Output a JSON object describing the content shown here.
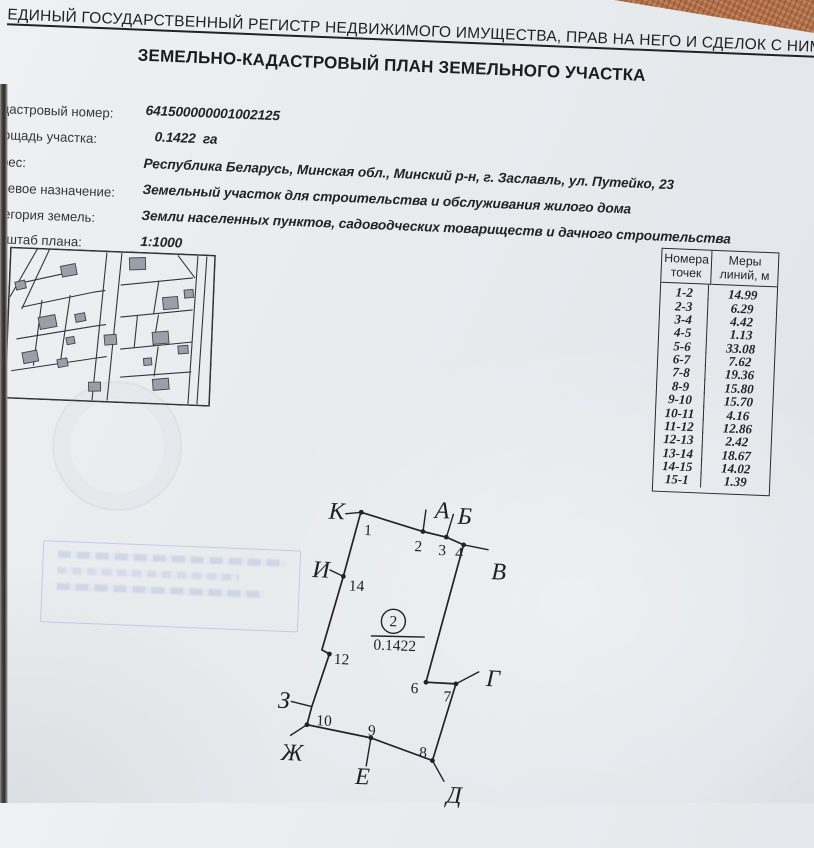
{
  "header": {
    "registry_line": "ЕДИНЫЙ ГОСУДАРСТВЕННЫЙ РЕГИСТР НЕДВИЖИМОГО ИМУЩЕСТВА, ПРАВ НА НЕГО И СДЕЛОК С НИМ",
    "title": "ЗЕМЕЛЬНО-КАДАСТРОВЫЙ ПЛАН ЗЕМЕЛЬНОГО УЧАСТКА"
  },
  "fields": [
    {
      "label": "Кадастровый номер:",
      "value": "641500000001002125"
    },
    {
      "label": "Площадь участка:",
      "value": "0.1422  га"
    },
    {
      "label": "Адрес:",
      "value": "Республика Беларусь, Минская обл., Минский р-н, г. Заславль, ул. Путейко, 23"
    },
    {
      "label": "Целевое назначение:",
      "value": "Земельный участок для строительства и обслуживания жилого дома"
    },
    {
      "label": "Категория земель:",
      "value": "Земли населенных пунктов, садоводческих товариществ и дачного строительства"
    },
    {
      "label": "Масштаб плана:",
      "value": "1:1000"
    }
  ],
  "table": {
    "col_points": "Номера точек",
    "col_lengths": "Меры линий, м",
    "rows": [
      {
        "points": "1-2",
        "m": "14.99"
      },
      {
        "points": "2-3",
        "m": "6.29"
      },
      {
        "points": "3-4",
        "m": "4.42"
      },
      {
        "points": "4-5",
        "m": "1.13"
      },
      {
        "points": "5-6",
        "m": "33.08"
      },
      {
        "points": "6-7",
        "m": "7.62"
      },
      {
        "points": "7-8",
        "m": "19.36"
      },
      {
        "points": "8-9",
        "m": "15.80"
      },
      {
        "points": "9-10",
        "m": "15.70"
      },
      {
        "points": "10-11",
        "m": "4.16"
      },
      {
        "points": "11-12",
        "m": "12.86"
      },
      {
        "points": "12-13",
        "m": "2.42"
      },
      {
        "points": "13-14",
        "m": "18.67"
      },
      {
        "points": "14-15",
        "m": "14.02"
      },
      {
        "points": "15-1",
        "m": "1.39"
      }
    ]
  },
  "diagram": {
    "parcel_number": "2",
    "area": "0.1422",
    "letters": {
      "k": "К",
      "a": "А",
      "b": "Б",
      "v": "В",
      "i": "И",
      "g": "Г",
      "z": "З",
      "zh": "Ж",
      "e": "Е",
      "d": "Д"
    },
    "numbers": {
      "n1": "1",
      "n2": "2",
      "n3": "3",
      "n4": "4",
      "n6": "6",
      "n7": "7",
      "n8": "8",
      "n9": "9",
      "n10": "10",
      "n12": "12",
      "n14": "14"
    }
  },
  "colors": {
    "paper": "#e8ebee",
    "ink": "#26262a",
    "background_surface": "#b5724a",
    "stamp_blue": "#6980c3"
  }
}
